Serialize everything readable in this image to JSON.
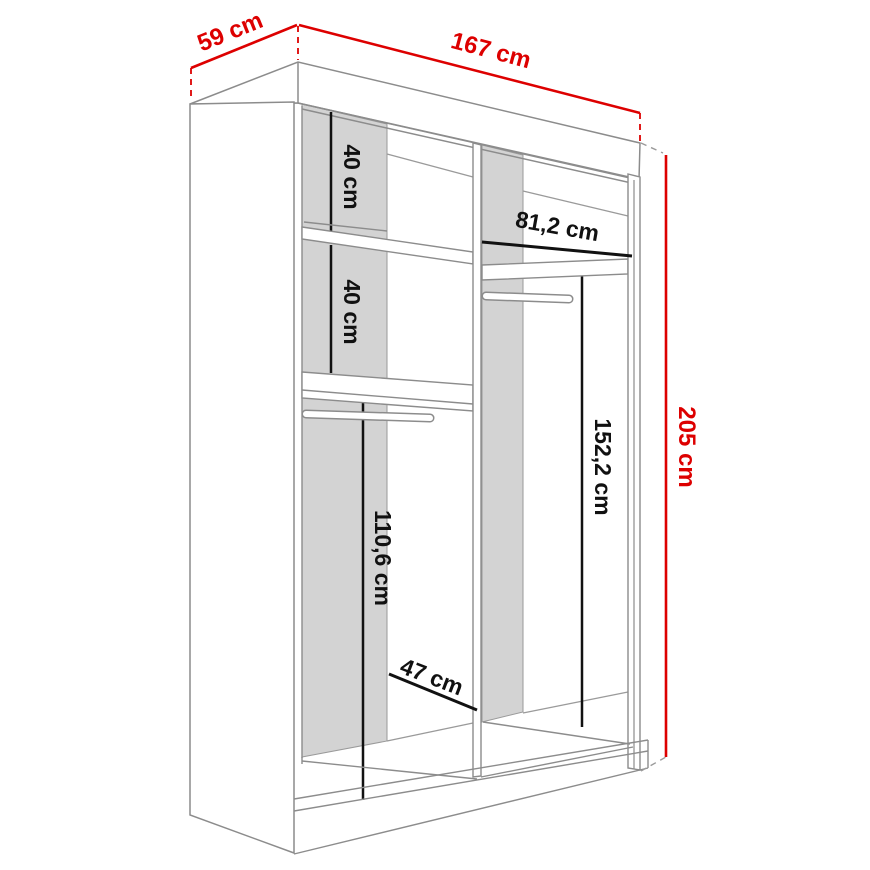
{
  "diagram": {
    "type": "wardrobe-dimension-drawing",
    "overall": {
      "depth": "59 cm",
      "width": "167 cm",
      "height": "205 cm"
    },
    "interior": {
      "upper_shelf_spacing": "40 cm",
      "middle_shelf_spacing": "40 cm",
      "right_shelf_width": "81,2 cm",
      "right_hanging_height": "152,2 cm",
      "left_hanging_height": "110,6 cm",
      "left_bottom_width": "47 cm"
    },
    "colors": {
      "dimension_red": "#dd0000",
      "dimension_black": "#111111",
      "structure_gray": "#8c8c8c",
      "panel_gray": "#d3d3d3"
    }
  }
}
